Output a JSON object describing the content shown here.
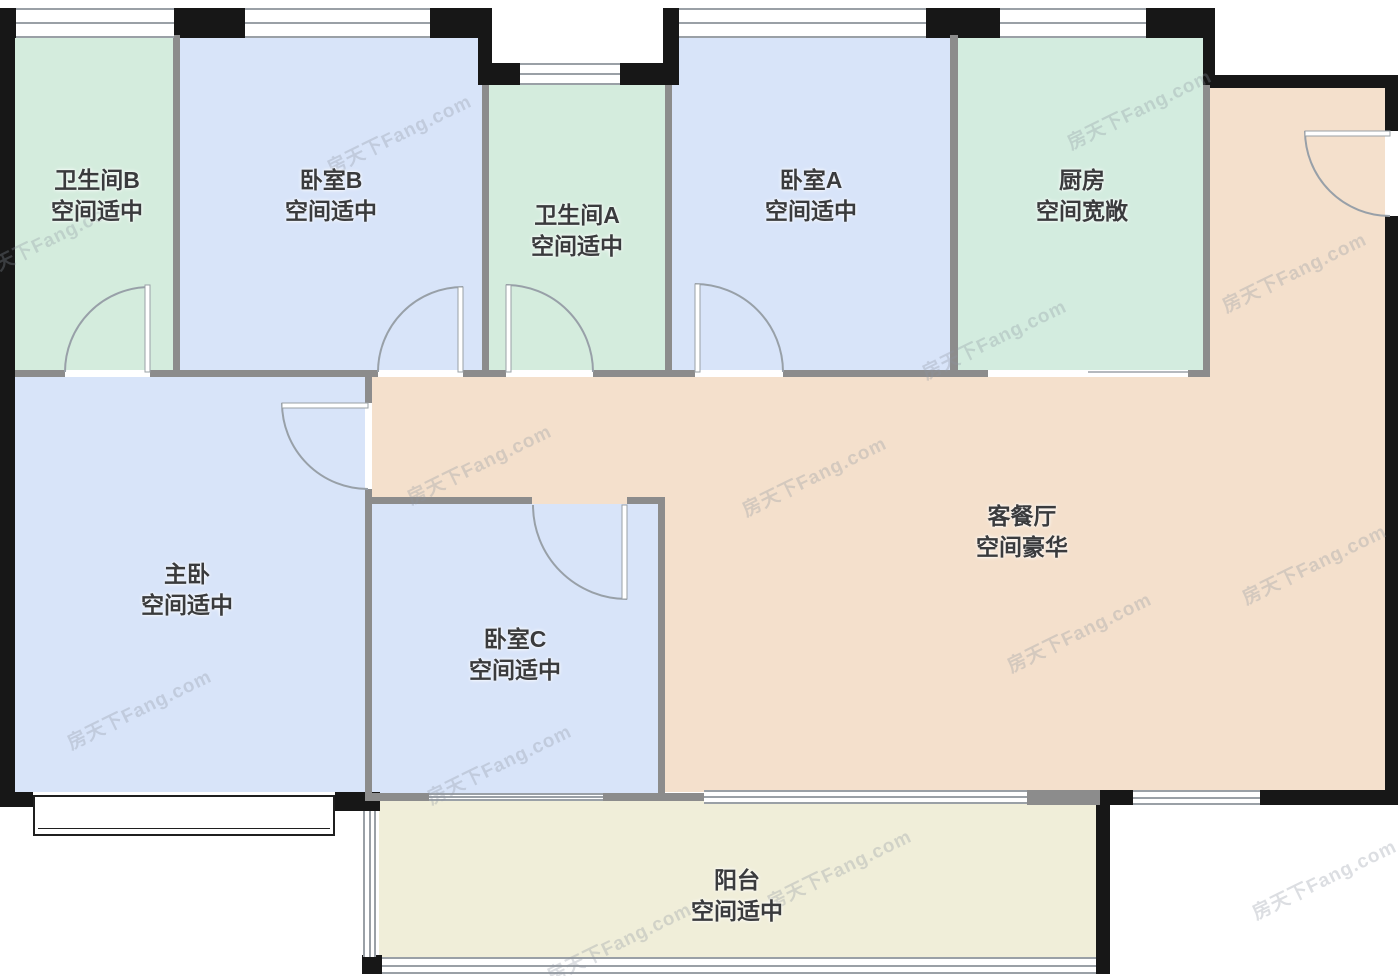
{
  "watermark": "房天下Fang.com",
  "colors": {
    "bedroom": "#d8e4f9",
    "bathroom": "#d4ecdd",
    "kitchen": "#d3ecdf",
    "living": "#f4e0cc",
    "balcony": "#f0eed9",
    "wall_exterior": "#171717",
    "wall_interior": "#8c8c8c",
    "label_text": "#3a3b3d"
  },
  "rooms": [
    {
      "id": "bathroom-b",
      "name": "卫生间B",
      "status": "空间适中"
    },
    {
      "id": "bedroom-b",
      "name": "卧室B",
      "status": "空间适中"
    },
    {
      "id": "bathroom-a",
      "name": "卫生间A",
      "status": "空间适中"
    },
    {
      "id": "bedroom-a",
      "name": "卧室A",
      "status": "空间适中"
    },
    {
      "id": "kitchen",
      "name": "厨房",
      "status": "空间宽敞"
    },
    {
      "id": "master-bedroom",
      "name": "主卧",
      "status": "空间适中"
    },
    {
      "id": "bedroom-c",
      "name": "卧室C",
      "status": "空间适中"
    },
    {
      "id": "living-dining",
      "name": "客餐厅",
      "status": "空间豪华"
    },
    {
      "id": "balcony",
      "name": "阳台",
      "status": "空间适中"
    }
  ]
}
